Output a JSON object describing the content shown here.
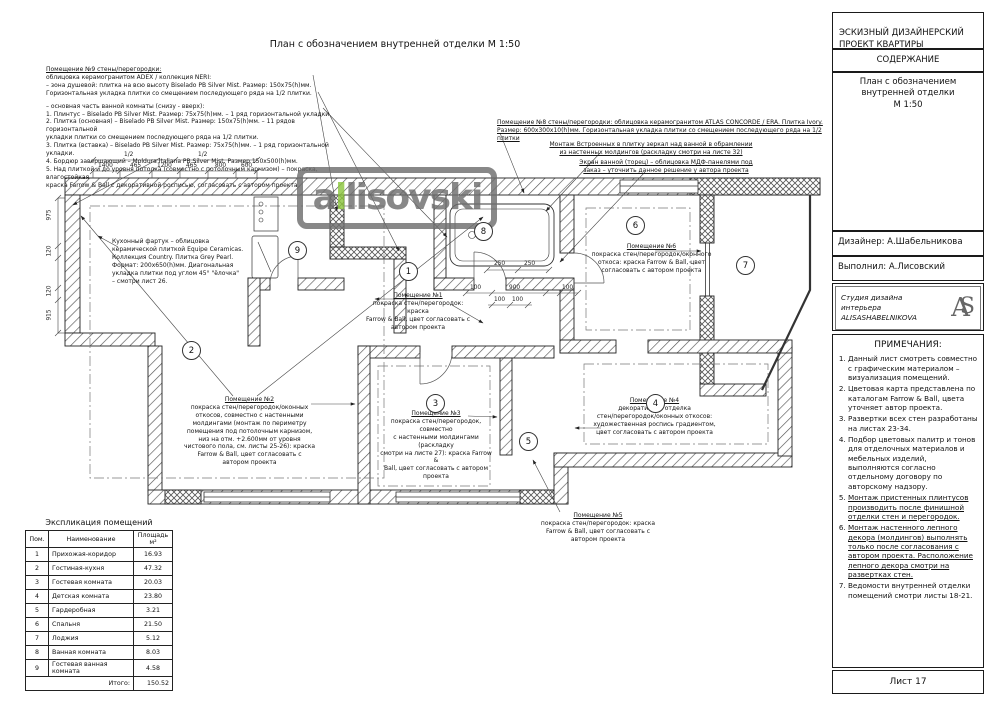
{
  "plan": {
    "title": "План с обозначением внутренней отделки М 1:50",
    "watermark": {
      "part1": "a",
      "accent": "l",
      "part2": "lisovski"
    },
    "accent_green": "#8dc63f",
    "room_markers": [
      "1",
      "2",
      "3",
      "4",
      "5",
      "6",
      "7",
      "8",
      "9"
    ],
    "dims_top_half": [
      "1/2",
      "1/2"
    ],
    "dims_top": [
      "1400",
      "465",
      "1200",
      "465",
      "800",
      "600"
    ],
    "dims_left": [
      "975",
      "120",
      "120",
      "915"
    ],
    "dims_bath": [
      "250",
      "250",
      "100",
      "900",
      "100",
      "100",
      "100"
    ],
    "notes": {
      "room9_header": "Помещение №9 стены/перегородки:",
      "room9_intro": "облицовка керамогранитом ADEX / коллекция NERI:\n– зона душевой: плитка на всю высоту Biselado PB Silver Mist. Размер: 150x75(h)мм.\nГоризонтальная укладка плитки со смещением последующего ряда на 1/2 плитки.",
      "room9_list": "– основная часть ванной комнаты (снизу - вверх):\n1. Плинтус – Biselado PB Silver Mist. Размер: 75x75(h)мм. – 1 ряд горизонтальной укладки.\n2. Плитка (основная) – Biselado PB Silver Mist. Размер: 150x75(h)мм. – 11 рядов горизонтальной\nукладки плитки со смещением последующего ряда на 1/2 плитки.\n3. Плитка (вставка) – Biselado PB Silver Mist. Размер: 75x75(h)мм. – 1 ряд горизонтальной укладки.\n4. Бордюр завершающий – Moldura Italiana PB Silver Mist. Размер 150x500(h)мм.\n5. Над плиткой и до уровня потолка (совместно с потолочным карнизом) – покраска, влагостойкая\nкраска Farrow & Ball с декоративной росписью, согласовать с автором проекта",
      "room8_title": "Помещение №8 стены/перегородки: облицовка керамогранитом ATLAS CONCORDE / ERA. Плитка Ivory.",
      "room8_body": "Размер: 600x300x10(h)мм. Горизонтальная укладка плитки со смещением последующего ряда на 1/2 плитки",
      "mirror": "Монтаж Встроенных в плитку зеркал над ванной в обрамлении\nиз настенных молдингов (раскладку смотри на листе 32)",
      "screen": "Экран ванной (торец) – облицовка МДФ-панелями под\nзаказ – уточнить данное решение у автора проекта",
      "kitchen": "Кухонный фартук – облицовка\nкерамической плиткой Equipe Ceramicas.\nКоллекция Country. Плитка Grey Pearl.\nФормат: 200x650(h)мм. Диагональная\nукладка плитки под углом 45° \"ёлочка\"\n– смотри лист 26.",
      "room1_title": "Помещение №1",
      "room1_body": "покраска стен/перегородок: краска\nFarrow & Ball, цвет согласовать с\nавтором проекта",
      "room2_title": "Помещение №2",
      "room2_body": "покраска стен/перегородок/оконных\nоткосов, совместно с настенными\nмолдингами (монтаж по периметру\nпомещения под потолочным карнизом,\nниз на отм. +2.600мм от уровня\nчистового пола, см. листы 25-26): краска\nFarrow & Ball, цвет согласовать с\nавтором проекта",
      "room3_title": "Помещение №3",
      "room3_body": "покраска стен/перегородок, совместно\nс настенными молдингами (раскладку\nсмотри на листе 27): краска Farrow &\nBall, цвет согласовать с автором\nпроекта",
      "room4_title": "Помещение №4",
      "room4_body": "декоративная отделка\nстен/перегородок/оконных откосов:\nхудожественная роспись градиентом,\nцвет согласовать с автором проекта",
      "room5_title": "Помещение №5",
      "room5_body": "покраска стен/перегородок: краска\nFarrow & Ball, цвет согласовать с\nавтором проекта",
      "room6_title": "Помещение №6",
      "room6_body": "покраска стен/перегородок/оконного\nоткоса: краска Farrow & Ball, цвет\nсогласовать с автором проекта"
    }
  },
  "legend_table": {
    "title": "Экспликация помещений",
    "headers": [
      "Пом.",
      "Наименование",
      "Площадь\nм²"
    ],
    "rows": [
      [
        "1",
        "Прихожая-коридор",
        "16.93"
      ],
      [
        "2",
        "Гостиная-кухня",
        "47.32"
      ],
      [
        "3",
        "Гостевая комната",
        "20.03"
      ],
      [
        "4",
        "Детская комната",
        "23.80"
      ],
      [
        "5",
        "Гардеробная",
        "3.21"
      ],
      [
        "6",
        "Спальня",
        "21.50"
      ],
      [
        "7",
        "Лоджия",
        "5.12"
      ],
      [
        "8",
        "Ванная комната",
        "8.03"
      ],
      [
        "9",
        "Гостевая ванная\nкомната",
        "4.58"
      ]
    ],
    "total_label": "Итого:",
    "total_value": "150.52"
  },
  "titleblock": {
    "project": "ЭСКИЗНЫЙ ДИЗАЙНЕРСКИЙ\nПРОЕКТ КВАРТИРЫ",
    "contents_label": "СОДЕРЖАНИЕ",
    "contents_item": "План с обозначением\nвнутренней отделки\nМ 1:50",
    "designer": "Дизайнер: А.Шабельникова",
    "executor": "Выполнил: А.Лисовский",
    "studio": "Студия дизайна\nинтерьера\nALISASHABELNIKOVA",
    "studio_monogram_a": "A",
    "studio_monogram_s": "S",
    "notes_title": "ПРИМЕЧАНИЯ:",
    "notes": [
      "Данный лист смотреть совместно с графическим материалом – визуализация помещений.",
      "Цветовая карта представлена по каталогам Farrow & Ball, цвета уточняет автор проекта.",
      "Развертки всех стен разработаны на листах 23-34.",
      "Подбор цветовых палитр и тонов для отделочных материалов и мебельных изделий, выполняются согласно отдельному договору по авторскому надзору.",
      "Монтаж пристенных плинтусов производить после финишной отделки стен и перегородок.",
      "Монтаж настенного лепного декора (молдингов) выполнять только после согласования с автором проекта. Расположение лепного декора смотри на развертках стен.",
      "Ведомости внутренней отделки помещений смотри листы 18-21."
    ],
    "sheet_label": "Лист 17"
  }
}
